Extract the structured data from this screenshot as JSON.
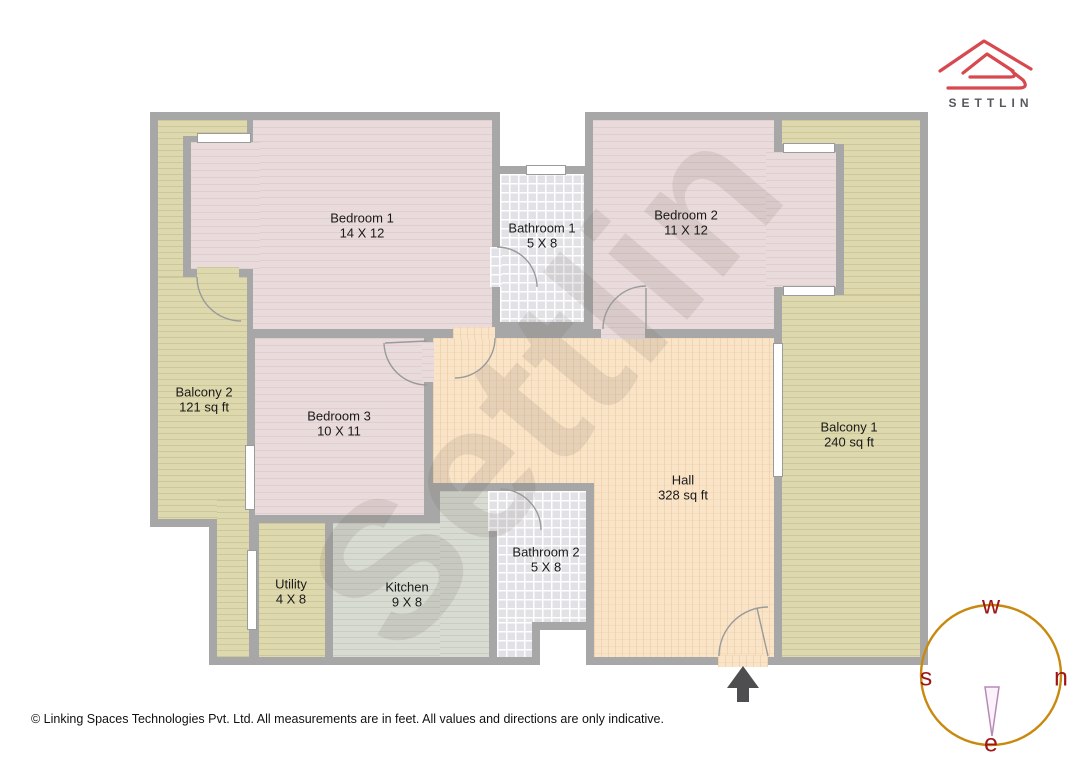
{
  "brand": {
    "logo_text": "SETTLIN",
    "logo_color": "#d8494f",
    "logo_text_color": "#55595e"
  },
  "watermark": {
    "text": "Settlin"
  },
  "rooms": [
    {
      "id": "bedroom-1",
      "name": "Bedroom 1",
      "dims": "14 X 12"
    },
    {
      "id": "bathroom-1",
      "name": "Bathroom 1",
      "dims": "5 X 8"
    },
    {
      "id": "bedroom-2",
      "name": "Bedroom 2",
      "dims": "11 X 12"
    },
    {
      "id": "balcony-2",
      "name": "Balcony 2",
      "dims": "121 sq ft"
    },
    {
      "id": "bedroom-3",
      "name": "Bedroom 3",
      "dims": "10 X 11"
    },
    {
      "id": "hall",
      "name": "Hall",
      "dims": "328 sq ft"
    },
    {
      "id": "balcony-1",
      "name": "Balcony 1",
      "dims": "240 sq ft"
    },
    {
      "id": "utility",
      "name": "Utility",
      "dims": "4 X 8"
    },
    {
      "id": "kitchen",
      "name": "Kitchen",
      "dims": "9 X 8"
    },
    {
      "id": "bathroom-2",
      "name": "Bathroom 2",
      "dims": "5 X 8"
    }
  ],
  "compass": {
    "top": "w",
    "left": "s",
    "right": "n",
    "bottom": "e",
    "ring_color": "#c9890f",
    "letter_color": "#9e1515",
    "needle_stroke": "#b78ab8"
  },
  "footer": {
    "disclaimer": "© Linking Spaces Technologies Pvt. Ltd. All measurements are in feet. All values and directions are only indicative."
  },
  "colors": {
    "wall": "#a7a7a7",
    "bedroom_floor": "#e9dbdb",
    "balcony_floor": "#ddd8ad",
    "hall_floor": "#f9e4c8",
    "kitchen_floor": "#d7dbd2",
    "bathroom_floor": "#e2e2e6",
    "window": "#ffffff",
    "entrance_arrow": "#4e4e50",
    "logo_red": "#d8494f"
  }
}
